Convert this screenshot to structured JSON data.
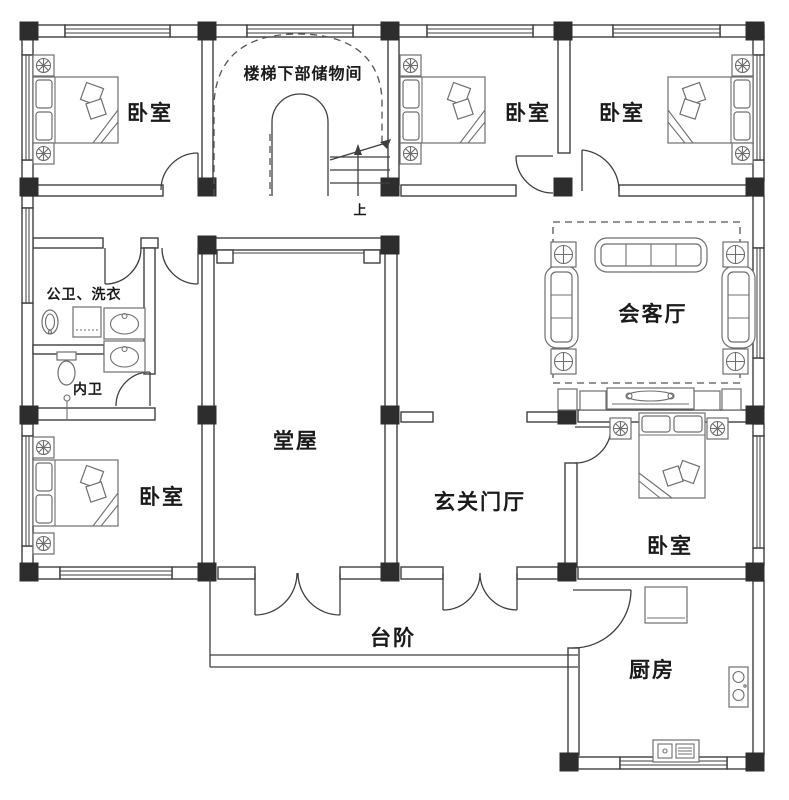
{
  "rooms": {
    "bedroom_top_left": {
      "label": "卧室"
    },
    "bedroom_top_middle": {
      "label": "卧室"
    },
    "bedroom_top_right": {
      "label": "卧室"
    },
    "bedroom_bottom_left": {
      "label": "卧室"
    },
    "bedroom_right": {
      "label": "卧室"
    },
    "stair_storage": {
      "label": "楼梯下部储物间"
    },
    "stair_up": {
      "label": "上"
    },
    "bath_public": {
      "label": "公卫、洗衣"
    },
    "bath_private": {
      "label": "内卫"
    },
    "living_room": {
      "label": "会客厅"
    },
    "main_hall": {
      "label": "堂屋"
    },
    "entrance_hall": {
      "label": "玄关门厅"
    },
    "steps": {
      "label": "台阶"
    },
    "kitchen": {
      "label": "厨房"
    }
  },
  "colors": {
    "wall_line": "#3f3f3f",
    "column_fill": "#2d2d2d",
    "furniture_line": "#6f6f6f",
    "dash_line": "#555555",
    "text": "#1a1a1a",
    "background": "#ffffff"
  }
}
